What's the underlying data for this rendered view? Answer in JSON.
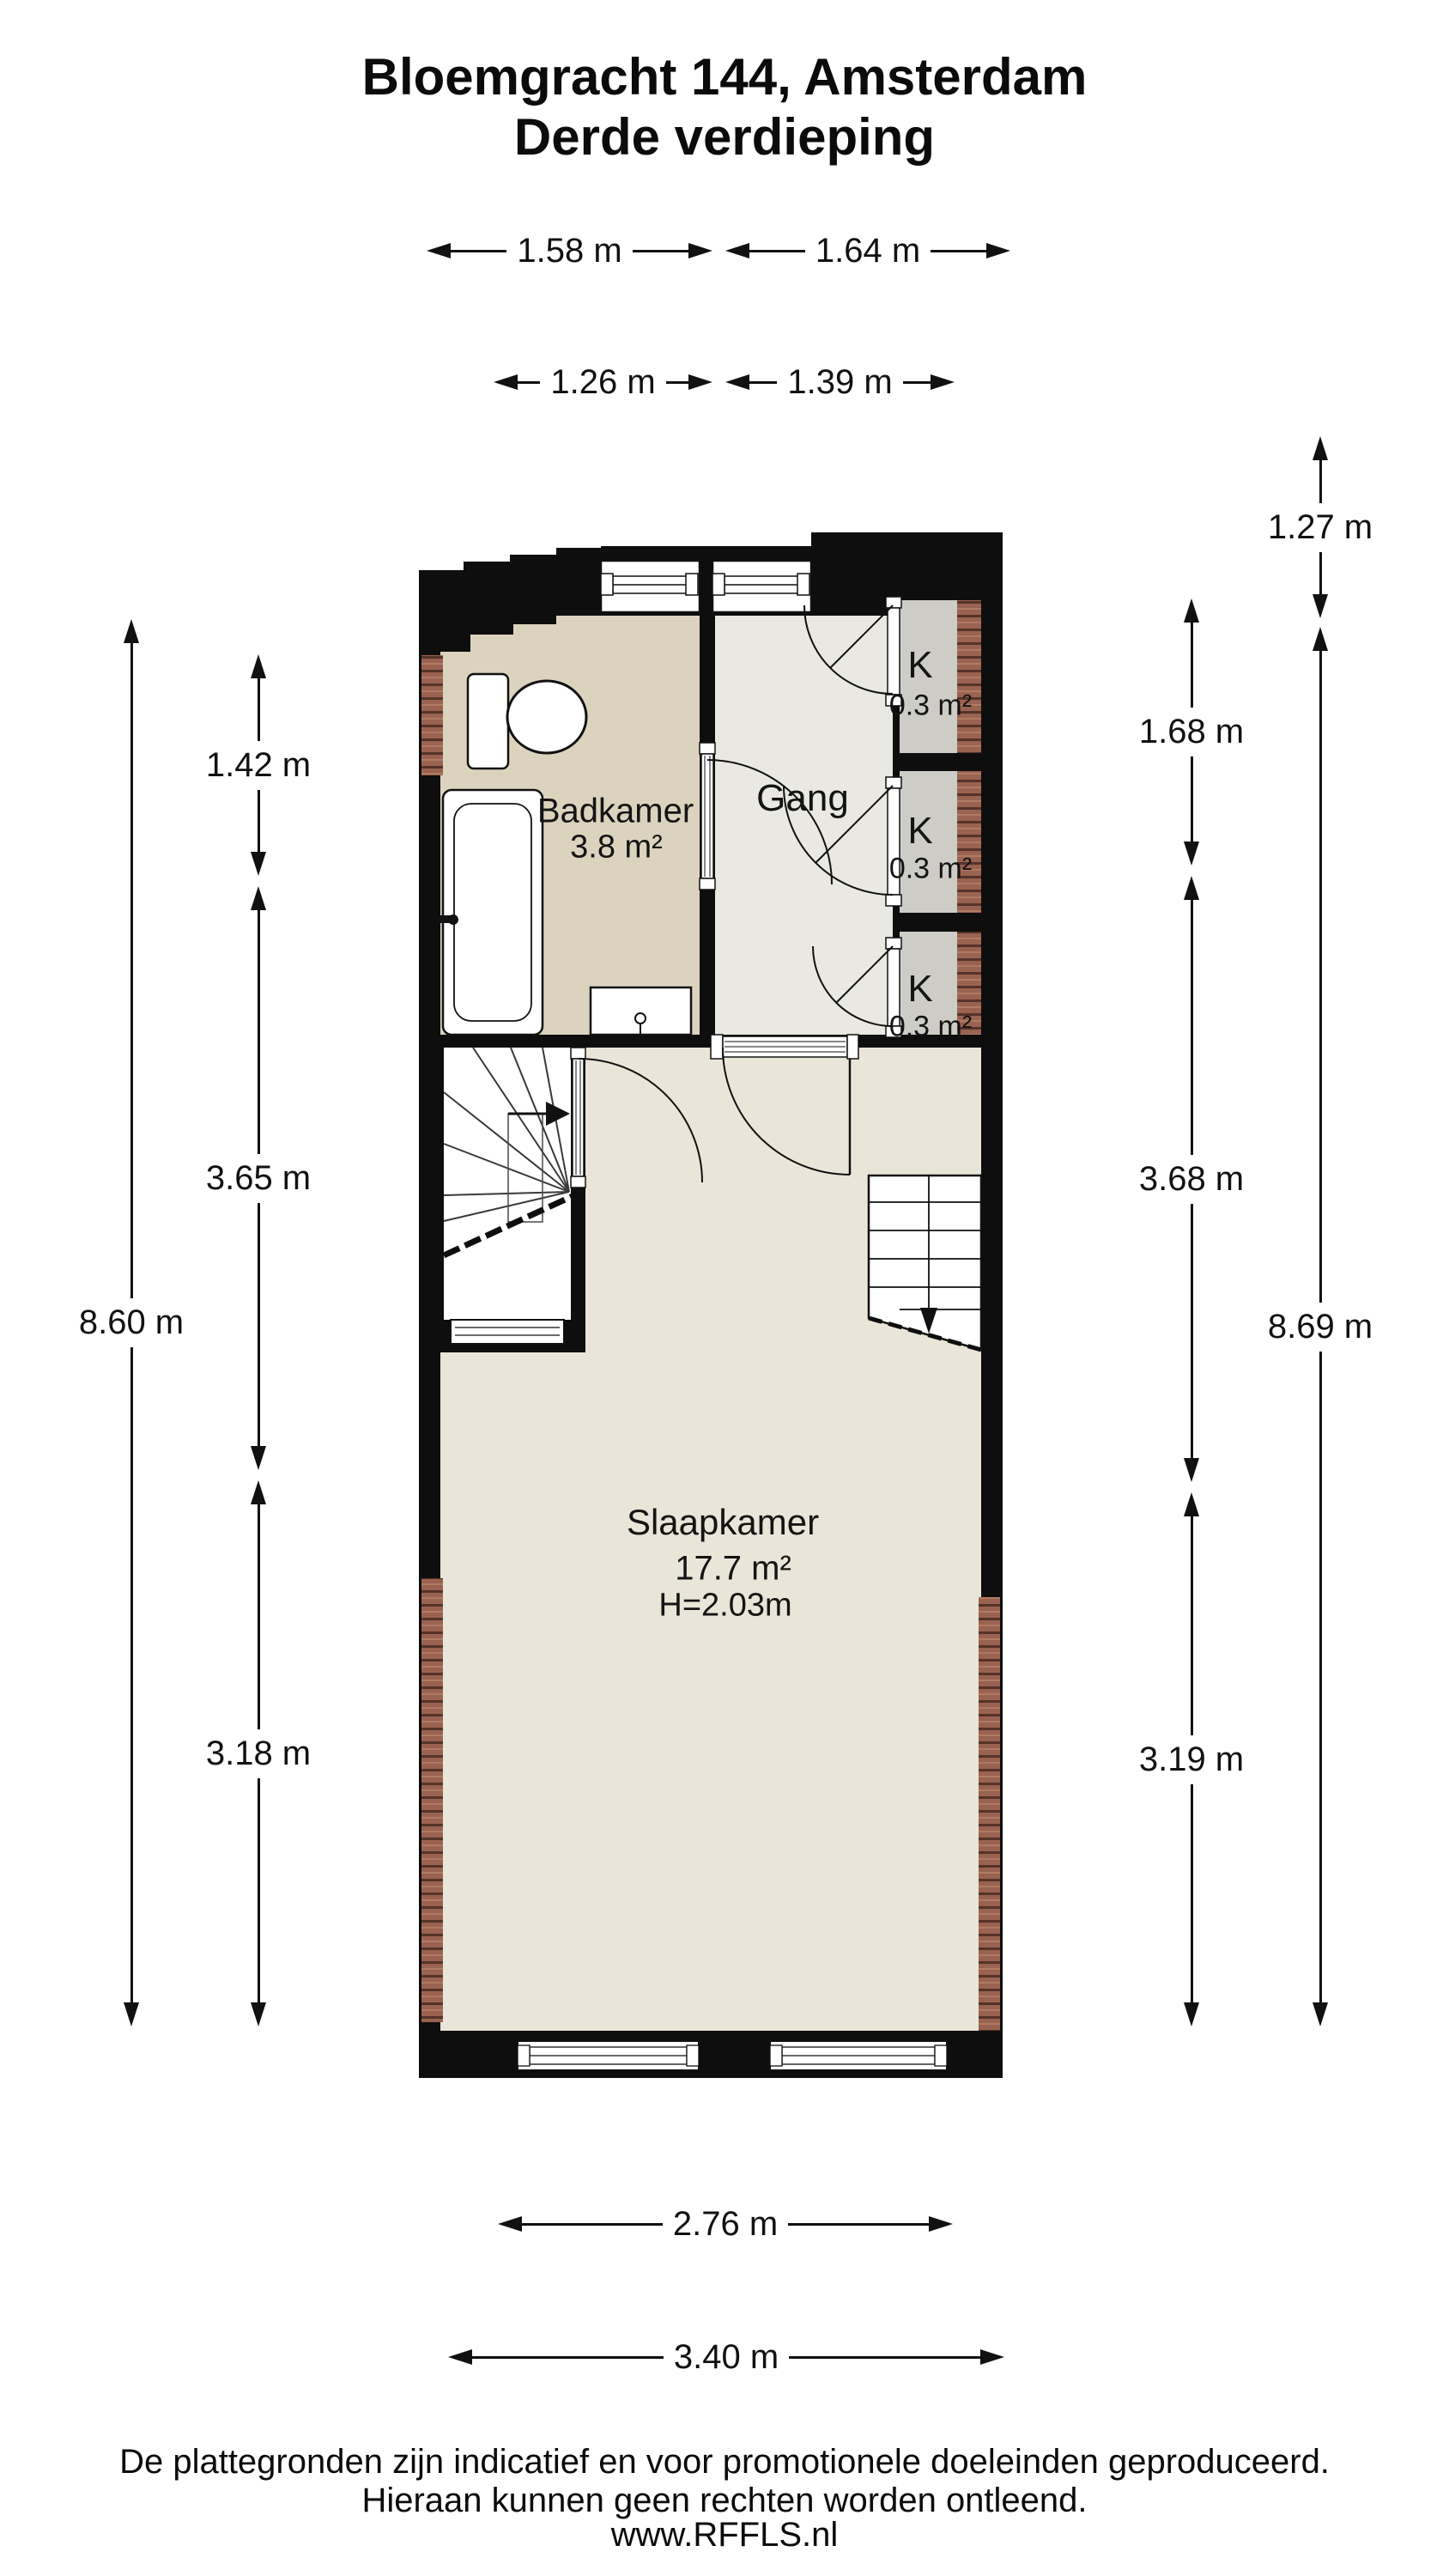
{
  "title": {
    "line1": "Bloemgracht 144, Amsterdam",
    "line2": "Derde verdieping"
  },
  "dimensions": {
    "top_row_1": [
      {
        "label": "1.58 m"
      },
      {
        "label": "1.64 m"
      }
    ],
    "top_row_2": [
      {
        "label": "1.26 m"
      },
      {
        "label": "1.39 m"
      }
    ],
    "left_segments": [
      {
        "label": "1.42 m"
      },
      {
        "label": "3.65 m"
      },
      {
        "label": "3.18 m"
      }
    ],
    "left_total": {
      "label": "8.60 m"
    },
    "right_segments": [
      {
        "label": "1.68 m"
      },
      {
        "label": "3.68 m"
      },
      {
        "label": "3.19 m"
      }
    ],
    "right_top": {
      "label": "1.27 m"
    },
    "right_total": {
      "label": "8.69 m"
    },
    "bottom_row_1": {
      "label": "2.76 m"
    },
    "bottom_row_2": {
      "label": "3.40 m"
    }
  },
  "rooms": {
    "badkamer": {
      "name": "Badkamer",
      "area": "3.8 m²"
    },
    "gang": {
      "name": "Gang"
    },
    "closets": [
      {
        "name": "K",
        "area": "0.3 m²"
      },
      {
        "name": "K",
        "area": "0.3 m²"
      },
      {
        "name": "K",
        "area": "0.3 m²"
      }
    ],
    "slaapkamer": {
      "name": "Slaapkamer",
      "area": "17.7 m²",
      "ceiling_height": "H=2.03m"
    }
  },
  "footer": {
    "line1": "De plattegronden zijn indicatief en voor promotionele doeleinden geproduceerd.",
    "line2": "Hieraan kunnen geen rechten worden ontleend.",
    "line3": "www.RFFLS.nl"
  },
  "colors": {
    "wall": "#0e0e0e",
    "floor-badkamer": "#dcd3bf",
    "floor-gang": "#e9e8e3",
    "floor-closet": "#cdccc7",
    "floor-slaapkamer": "#e9e5d8",
    "floor-stairs": "#ffffff",
    "brick": "#9a6250",
    "brick-dark": "#55332a",
    "line": "#1a1a1a"
  }
}
